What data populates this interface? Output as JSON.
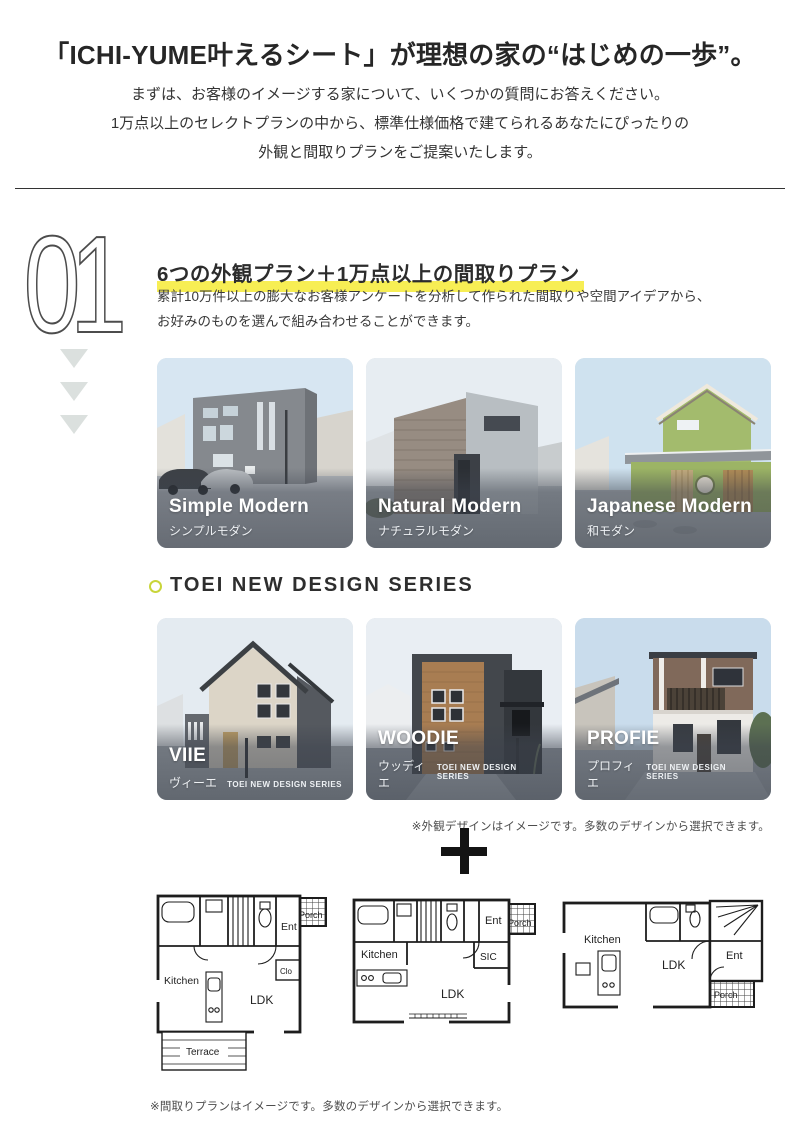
{
  "header": {
    "title": "「ICHI-YUME叶えるシート」が理想の家の“はじめの一歩”。",
    "intro_lines": [
      "まずは、お客様のイメージする家について、いくつかの質問にお答えください。",
      "1万点以上のセレクトプランの中から、標準仕様価格で建てられるあなたにぴったりの",
      "外観と間取りプランをご提案いたします。"
    ]
  },
  "section01": {
    "number": "01",
    "heading": "6つの外観プラン＋1万点以上の間取りプラン",
    "body_lines": [
      "累計10万件以上の膨大なお客様アンケートを分析して作られた間取りや空間アイデアから、",
      "お好みのものを選んで組み合わせることができます。"
    ],
    "exterior_cards": [
      {
        "name_en": "Simple Modern",
        "name_ja": "シンプルモダン"
      },
      {
        "name_en": "Natural Modern",
        "name_ja": "ナチュラルモダン"
      },
      {
        "name_en": "Japanese Modern",
        "name_ja": "和モダン"
      }
    ],
    "series_heading": "TOEI NEW DESIGN SERIES",
    "series_cards": [
      {
        "name_en": "VIIE",
        "name_ja": "ヴィーエ",
        "series_tag": "TOEI NEW DESIGN SERIES"
      },
      {
        "name_en": "WOODIE",
        "name_ja": "ウッディエ",
        "series_tag": "TOEI NEW DESIGN SERIES"
      },
      {
        "name_en": "PROFIE",
        "name_ja": "プロフィエ",
        "series_tag": "TOEI NEW DESIGN SERIES"
      }
    ],
    "exterior_note": "※外観デザインはイメージです。多数のデザインから選択できます。",
    "plus_symbol": "＋",
    "floorplans": {
      "plan1": {
        "ent": "Ent",
        "porch": "Porch",
        "clo": "Clo",
        "kitchen": "Kitchen",
        "ldk": "LDK",
        "terrace": "Terrace"
      },
      "plan2": {
        "kitchen": "Kitchen",
        "ent": "Ent",
        "porch": "Porch",
        "sic": "SIC",
        "ldk": "LDK"
      },
      "plan3": {
        "kitchen": "Kitchen",
        "ldk": "LDK",
        "ent": "Ent",
        "porch": "Porch"
      }
    },
    "floorplan_note": "※間取りプランはイメージです。多数のデザインから選択できます。"
  },
  "colors": {
    "highlight_yellow": "#f7ee54",
    "bullet_yellow_green": "#c9d53a",
    "triangle_gray": "#dbe0de",
    "text_dark": "#333333",
    "note_gray": "#4d4d4d"
  }
}
